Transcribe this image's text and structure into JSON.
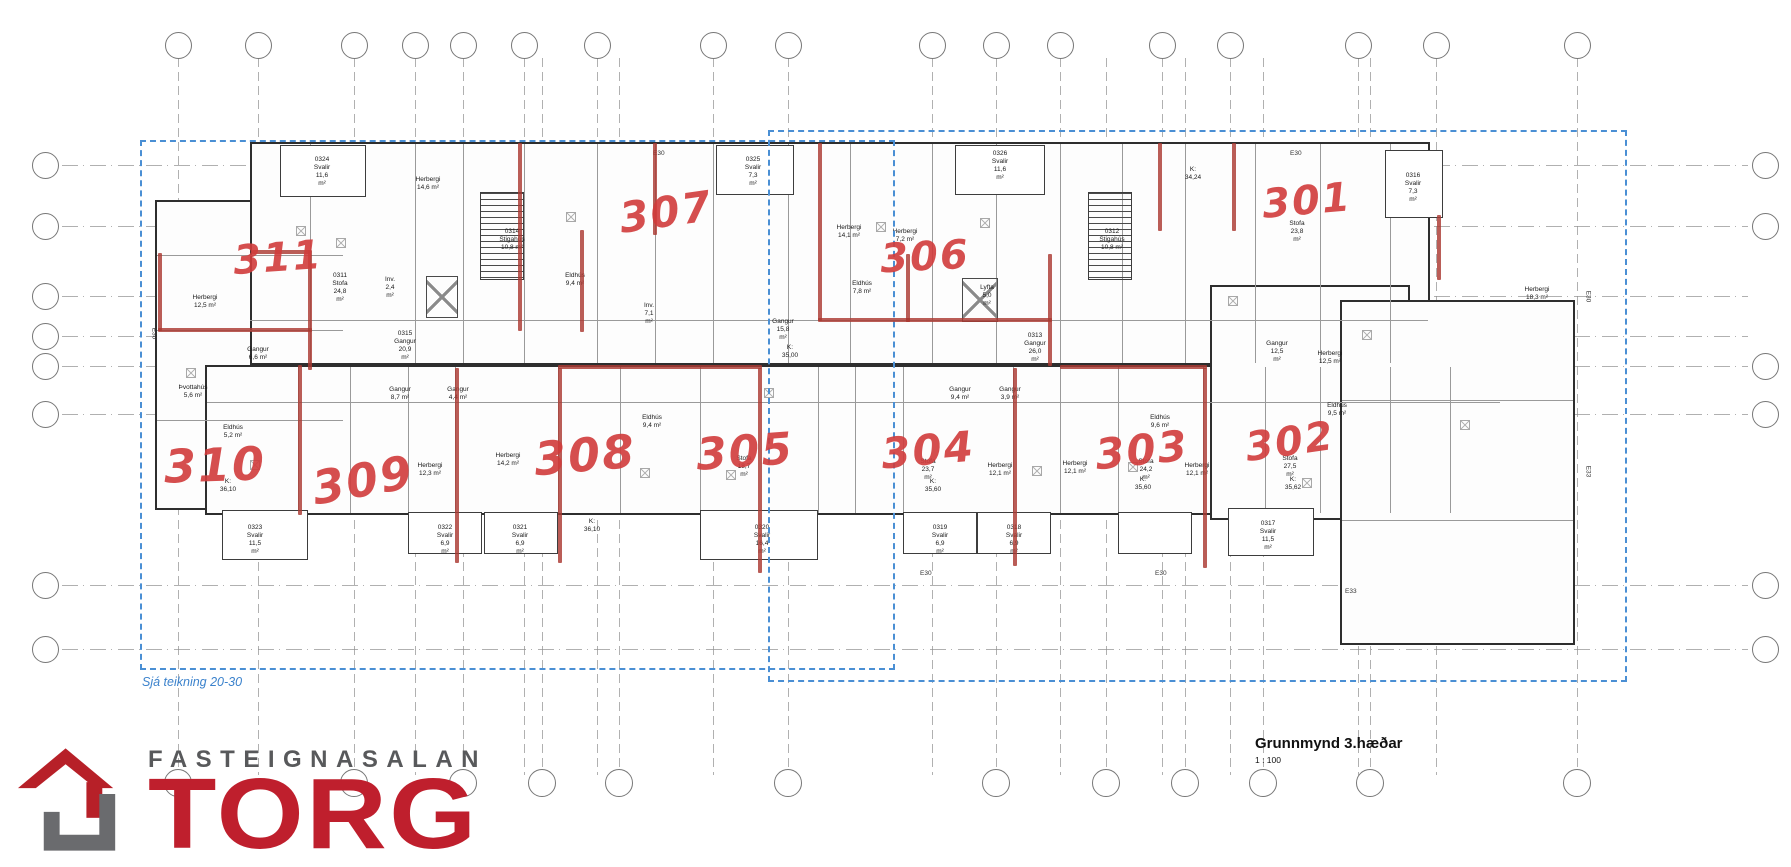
{
  "title_block": {
    "title": "Grunnmynd 3.hæðar",
    "scale": "1 : 100"
  },
  "logo": {
    "name_line": "FASTEIGNASALAN",
    "brand": "TORG",
    "brand_color": "#bf1f2d",
    "name_color": "#58595b",
    "icon": "house-logo"
  },
  "ref_boxes": [
    {
      "caption": "Sjá teikning 20-30",
      "x": 140,
      "y": 140,
      "w": 755,
      "h": 530,
      "caption_pos": "bl"
    },
    {
      "caption": "Sjá teikning 20-31",
      "x": 768,
      "y": 130,
      "w": 859,
      "h": 552,
      "caption_pos": "br"
    }
  ],
  "grid": {
    "top_row_y": 45,
    "bottom_row_y": 783,
    "left_col_x": 45,
    "right_col_x": 1765,
    "line_top": 58,
    "line_bottom": 775,
    "line_left": 62,
    "line_right": 1748,
    "vlines": [
      {
        "n": "1",
        "x": 178,
        "t": true,
        "b": true
      },
      {
        "n": "2",
        "x": 258,
        "t": true,
        "b": false
      },
      {
        "n": "3",
        "x": 354,
        "t": true,
        "b": true
      },
      {
        "n": "4",
        "x": 415,
        "t": true,
        "b": false
      },
      {
        "n": "5",
        "x": 463,
        "t": true,
        "b": true
      },
      {
        "n": "6",
        "x": 524,
        "t": true,
        "b": false
      },
      {
        "n": "7",
        "x": 542,
        "t": false,
        "b": true
      },
      {
        "n": "8",
        "x": 597,
        "t": true,
        "b": false
      },
      {
        "n": "9",
        "x": 619,
        "t": false,
        "b": true
      },
      {
        "n": "10",
        "x": 713,
        "t": true,
        "b": false
      },
      {
        "n": "11",
        "x": 788,
        "t": true,
        "b": true
      },
      {
        "n": "12",
        "x": 932,
        "t": true,
        "b": false
      },
      {
        "n": "13",
        "x": 996,
        "t": true,
        "b": true
      },
      {
        "n": "14",
        "x": 1060,
        "t": true,
        "b": false
      },
      {
        "n": "15",
        "x": 1106,
        "t": false,
        "b": true
      },
      {
        "n": "16",
        "x": 1162,
        "t": true,
        "b": false
      },
      {
        "n": "17",
        "x": 1185,
        "t": false,
        "b": true
      },
      {
        "n": "18",
        "x": 1230,
        "t": true,
        "b": false
      },
      {
        "n": "19",
        "x": 1263,
        "t": false,
        "b": true
      },
      {
        "n": "20",
        "x": 1358,
        "t": true,
        "b": false
      },
      {
        "n": "21",
        "x": 1370,
        "t": false,
        "b": true
      },
      {
        "n": "23",
        "x": 1436,
        "t": true,
        "b": false
      },
      {
        "n": "24",
        "x": 1577,
        "t": true,
        "b": true
      }
    ],
    "hlines": [
      {
        "n": "A",
        "y": 165,
        "l": true,
        "r": true
      },
      {
        "n": "B",
        "y": 226,
        "l": true,
        "r": true
      },
      {
        "n": "C",
        "y": 296,
        "l": true,
        "r": false
      },
      {
        "n": "D",
        "y": 336,
        "l": true,
        "r": false
      },
      {
        "n": "E",
        "y": 366,
        "l": true,
        "r": true
      },
      {
        "n": "F",
        "y": 414,
        "l": true,
        "r": true
      },
      {
        "n": "G",
        "y": 585,
        "l": true,
        "r": true
      },
      {
        "n": "H",
        "y": 649,
        "l": true,
        "r": true
      }
    ]
  },
  "apartments": {
    "color": "#d13c3c",
    "numbers": [
      {
        "label": "311",
        "x": 278,
        "y": 258,
        "size": 40,
        "rot": -4
      },
      {
        "label": "307",
        "x": 666,
        "y": 212,
        "size": 42,
        "rot": -8
      },
      {
        "label": "306",
        "x": 925,
        "y": 257,
        "size": 40,
        "rot": -3
      },
      {
        "label": "301",
        "x": 1307,
        "y": 201,
        "size": 40,
        "rot": -5
      },
      {
        "label": "310",
        "x": 215,
        "y": 465,
        "size": 46,
        "rot": -2
      },
      {
        "label": "309",
        "x": 363,
        "y": 480,
        "size": 46,
        "rot": -10
      },
      {
        "label": "308",
        "x": 585,
        "y": 455,
        "size": 46,
        "rot": -5
      },
      {
        "label": "305",
        "x": 745,
        "y": 452,
        "size": 44,
        "rot": -4
      },
      {
        "label": "304",
        "x": 928,
        "y": 450,
        "size": 42,
        "rot": -5
      },
      {
        "label": "303",
        "x": 1142,
        "y": 450,
        "size": 42,
        "rot": -6
      },
      {
        "label": "302",
        "x": 1290,
        "y": 442,
        "size": 40,
        "rot": -8
      }
    ]
  },
  "red_segments": [
    {
      "x": 158,
      "y": 253,
      "w": 4,
      "h": 78
    },
    {
      "x": 158,
      "y": 328,
      "w": 154,
      "h": 4
    },
    {
      "x": 308,
      "y": 250,
      "w": 4,
      "h": 120
    },
    {
      "x": 252,
      "y": 250,
      "w": 58,
      "h": 4
    },
    {
      "x": 518,
      "y": 143,
      "w": 4,
      "h": 188
    },
    {
      "x": 580,
      "y": 230,
      "w": 4,
      "h": 102
    },
    {
      "x": 653,
      "y": 143,
      "w": 4,
      "h": 92
    },
    {
      "x": 818,
      "y": 143,
      "w": 4,
      "h": 178
    },
    {
      "x": 818,
      "y": 318,
      "w": 92,
      "h": 4
    },
    {
      "x": 906,
      "y": 254,
      "w": 4,
      "h": 68
    },
    {
      "x": 906,
      "y": 318,
      "w": 146,
      "h": 4
    },
    {
      "x": 1048,
      "y": 254,
      "w": 4,
      "h": 112
    },
    {
      "x": 1158,
      "y": 143,
      "w": 4,
      "h": 88
    },
    {
      "x": 1232,
      "y": 143,
      "w": 4,
      "h": 88
    },
    {
      "x": 1437,
      "y": 215,
      "w": 4,
      "h": 65
    },
    {
      "x": 298,
      "y": 365,
      "w": 4,
      "h": 150
    },
    {
      "x": 455,
      "y": 368,
      "w": 4,
      "h": 195
    },
    {
      "x": 558,
      "y": 368,
      "w": 4,
      "h": 195
    },
    {
      "x": 758,
      "y": 368,
      "w": 4,
      "h": 205
    },
    {
      "x": 1013,
      "y": 368,
      "w": 4,
      "h": 198
    },
    {
      "x": 1203,
      "y": 368,
      "w": 4,
      "h": 200
    },
    {
      "x": 558,
      "y": 365,
      "w": 204,
      "h": 4
    },
    {
      "x": 1060,
      "y": 365,
      "w": 147,
      "h": 4
    }
  ],
  "room_labels": [
    {
      "t": "0324\nSvalir\n11,6 m²",
      "x": 322,
      "y": 156
    },
    {
      "t": "Herbergi\n14,6 m²",
      "x": 428,
      "y": 176
    },
    {
      "t": "0325\nSvalir\n7,3 m²",
      "x": 753,
      "y": 156
    },
    {
      "t": "0326\nSvalir\n11,6 m²",
      "x": 1000,
      "y": 150
    },
    {
      "t": "K: 34,24",
      "x": 1193,
      "y": 166
    },
    {
      "t": "0316\nSvalir\n7,3 m²",
      "x": 1413,
      "y": 172
    },
    {
      "t": "Herbergi\n14,1 m²",
      "x": 849,
      "y": 224
    },
    {
      "t": "Herbergi\n7,2 m²",
      "x": 905,
      "y": 228
    },
    {
      "t": "0311\nStofa\n24,8 m²",
      "x": 340,
      "y": 272
    },
    {
      "t": "0314\nStigahús\n10,8 m²",
      "x": 512,
      "y": 228
    },
    {
      "t": "0312\nStigahús\n10,8 m²",
      "x": 1112,
      "y": 228
    },
    {
      "t": "Stofa\n23,8 m²",
      "x": 1297,
      "y": 220
    },
    {
      "t": "Herbergi\n12,5 m²",
      "x": 205,
      "y": 294
    },
    {
      "t": "Inv.\n2,4 m²",
      "x": 390,
      "y": 276
    },
    {
      "t": "Lyfta\n5,0 m²",
      "x": 987,
      "y": 284
    },
    {
      "t": "Gangur\n6,6 m²",
      "x": 258,
      "y": 346
    },
    {
      "t": "0315\nGangur\n20,9 m²",
      "x": 405,
      "y": 330
    },
    {
      "t": "Gangur\n15,8 m²",
      "x": 783,
      "y": 318
    },
    {
      "t": "Eldhús\n7,8 m²",
      "x": 862,
      "y": 280
    },
    {
      "t": "K: 35,00",
      "x": 790,
      "y": 344
    },
    {
      "t": "0313\nGangur\n26,0 m²",
      "x": 1035,
      "y": 332
    },
    {
      "t": "Gangur\n12,5 m²",
      "x": 1277,
      "y": 340
    },
    {
      "t": "Herbergi\n18,3 m²",
      "x": 1537,
      "y": 286
    },
    {
      "t": "Inv.\n7,1 m²",
      "x": 649,
      "y": 302
    },
    {
      "t": "Eldhús\n9,4 m²",
      "x": 575,
      "y": 272
    },
    {
      "t": "Þvottahús\n5,6 m²",
      "x": 193,
      "y": 384
    },
    {
      "t": "Eldhús\n5,2 m²",
      "x": 233,
      "y": 424
    },
    {
      "t": "K: 36,10",
      "x": 228,
      "y": 478
    },
    {
      "t": "Gangur\n8,7 m²",
      "x": 400,
      "y": 386
    },
    {
      "t": "Gangur\n4,4 m²",
      "x": 458,
      "y": 386
    },
    {
      "t": "Herbergi\n12,3 m²",
      "x": 430,
      "y": 462
    },
    {
      "t": "Herbergi\n14,2 m²",
      "x": 508,
      "y": 452
    },
    {
      "t": "K: 36,10",
      "x": 592,
      "y": 518
    },
    {
      "t": "Eldhús\n9,4 m²",
      "x": 652,
      "y": 414
    },
    {
      "t": "Stofa\n18,7 m²",
      "x": 744,
      "y": 455
    },
    {
      "t": "Gangur\n9,4 m²",
      "x": 960,
      "y": 386
    },
    {
      "t": "Gangur\n3,9 m²",
      "x": 1010,
      "y": 386
    },
    {
      "t": "Stofa\n23,7 m²",
      "x": 928,
      "y": 458
    },
    {
      "t": "K: 35,60",
      "x": 933,
      "y": 478
    },
    {
      "t": "Herbergi\n12,1 m²",
      "x": 1000,
      "y": 462
    },
    {
      "t": "Herbergi\n12,1 m²",
      "x": 1075,
      "y": 460
    },
    {
      "t": "Eldhús\n9,6 m²",
      "x": 1160,
      "y": 414
    },
    {
      "t": "Stofa\n24,2 m²",
      "x": 1146,
      "y": 458
    },
    {
      "t": "K: 35,60",
      "x": 1143,
      "y": 476
    },
    {
      "t": "Herbergi\n12,1 m²",
      "x": 1197,
      "y": 462
    },
    {
      "t": "Stofa\n27,5 m²",
      "x": 1290,
      "y": 455
    },
    {
      "t": "K: 35,62",
      "x": 1293,
      "y": 476
    },
    {
      "t": "Eldhús\n9,5 m²",
      "x": 1337,
      "y": 402
    },
    {
      "t": "Herbergi\n12,5 m²",
      "x": 1330,
      "y": 350
    },
    {
      "t": "0323\nSvalir\n11,5 m²",
      "x": 255,
      "y": 524
    },
    {
      "t": "0322\nSvalir\n6,9 m²",
      "x": 445,
      "y": 524
    },
    {
      "t": "0321\nSvalir\n6,9 m²",
      "x": 520,
      "y": 524
    },
    {
      "t": "0320\nSvalir\n16,4 m²",
      "x": 762,
      "y": 524
    },
    {
      "t": "0319\nSvalir\n6,9 m²",
      "x": 940,
      "y": 524
    },
    {
      "t": "0318\nSvalir\n6,9 m²",
      "x": 1014,
      "y": 524
    },
    {
      "t": "0317\nSvalir\n11,5 m²",
      "x": 1268,
      "y": 520
    }
  ],
  "edge_labels": [
    {
      "t": "E30",
      "x": 653,
      "y": 150,
      "rot": 0
    },
    {
      "t": "E30",
      "x": 1290,
      "y": 150,
      "rot": 0
    },
    {
      "t": "E30",
      "x": 148,
      "y": 330,
      "rot": 90
    },
    {
      "t": "E30",
      "x": 1582,
      "y": 293,
      "rot": 90
    },
    {
      "t": "E33",
      "x": 1582,
      "y": 468,
      "rot": 90
    },
    {
      "t": "E30",
      "x": 920,
      "y": 570,
      "rot": 0
    },
    {
      "t": "E30",
      "x": 1155,
      "y": 570,
      "rot": 0
    },
    {
      "t": "E33",
      "x": 1345,
      "y": 588,
      "rot": 0
    }
  ]
}
